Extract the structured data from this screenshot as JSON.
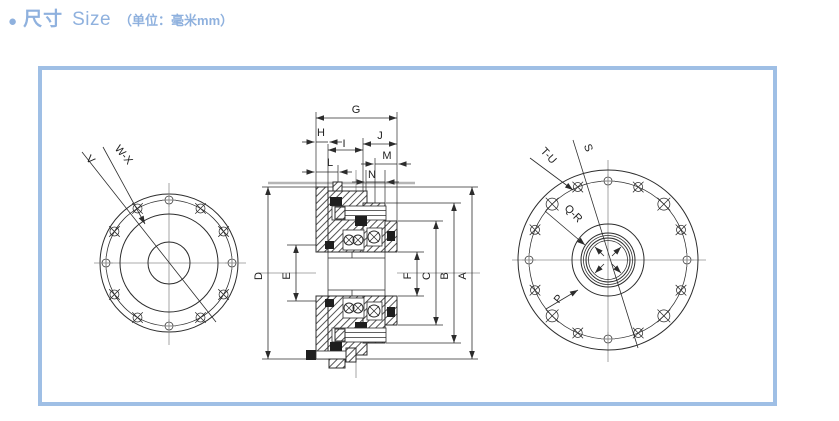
{
  "header": {
    "bullet": "●",
    "title_cn": "尺寸",
    "title_en": "Size",
    "unit_note": "（单位：毫米mm）"
  },
  "dimension_labels": {
    "G": "G",
    "H": "H",
    "I": "I",
    "J": "J",
    "L": "L",
    "M": "M",
    "N": "N",
    "D": "D",
    "E": "E",
    "F": "F",
    "C": "C",
    "B": "B",
    "A": "A"
  },
  "view_labels": {
    "V": "V",
    "WX": "W-X",
    "TU": "T-U",
    "S": "S",
    "QR": "Q-R",
    "P": "P"
  },
  "colors": {
    "accent_blue": "#8fb1de",
    "panel_border": "#9fbfe5",
    "line": "#2c2c2c",
    "centerline": "#8f8f8f"
  }
}
